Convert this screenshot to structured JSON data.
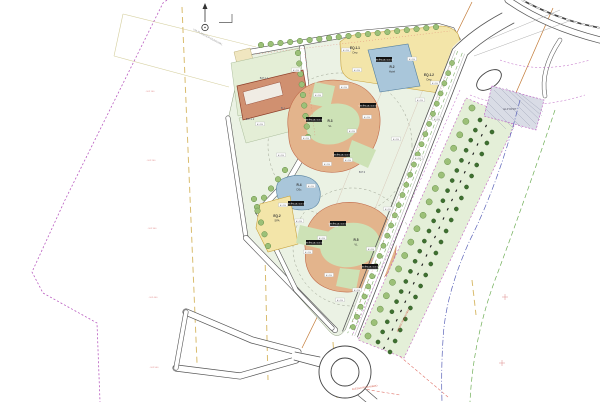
{
  "palette": {
    "paper": "#ffffff",
    "block_green": "#ebf2e4",
    "parcel_green": "#e4eed6",
    "ring_green": "#cde2b6",
    "lobe_tan": "#e3b48c",
    "lobe_stroke": "#c06a4a",
    "parcel_yellow": "#f3e5a9",
    "parcel_blue": "#a9c6da",
    "building_brown": "#d09070",
    "tree_light": "#9cc078",
    "tree_dark": "#3e7030",
    "road_casing": "#555555",
    "boundary_purple": "#b95cc0",
    "cad_yellow": "#d9bc6e",
    "cad_orange": "#c27a36",
    "cad_red": "#e0736a",
    "cad_blue": "#5b63b8",
    "cad_green": "#6fae57",
    "elp_gray": "#d9dce6"
  },
  "parcels": {
    "eq11": {
      "code": "EQ.1.1",
      "use": "Dep"
    },
    "r2": {
      "code": "R.2",
      "use": "Hotel"
    },
    "eq12": {
      "code": "EQ.1.2",
      "use": "Dep"
    },
    "r3": {
      "code": "R.3",
      "use": "VL"
    },
    "r4": {
      "code": "R.4",
      "use": "DSc"
    },
    "eq2": {
      "code": "EQ.2",
      "use": "SPA"
    },
    "r5": {
      "code": "R.5",
      "use": "VL"
    },
    "b1": {
      "code": "B.1"
    },
    "bp11": {
      "code": "B.P.1.1"
    },
    "bp12": {
      "code": "B.P.1.2"
    },
    "bp3": {
      "code": "B.P.3"
    },
    "elp": {
      "code": "ELP DPRT"
    }
  },
  "annotations": {
    "street_label": "VIA PLANEADA MUNICIPAL",
    "access_road_1": "ACESSO RODOVIÁRIO",
    "access_road_2": "ACESSO RODOVIÁRIO",
    "black_box_text": "CEDÊNCIA 2.400 m²",
    "mini_label_text": "A 1.250",
    "grid_labels": [
      "-102 100",
      "-102 200",
      "-102 300",
      "-102 400",
      "-102 500"
    ]
  },
  "decor": {
    "tree_rows": [
      {
        "x1": 261,
        "y1": 45,
        "x2": 436,
        "y2": 27,
        "n": 19,
        "r": 2.8,
        "t": "light"
      },
      {
        "x1": 298,
        "y1": 53,
        "x2": 308,
        "y2": 137,
        "n": 9,
        "r": 2.8,
        "t": "light"
      },
      {
        "x1": 285,
        "y1": 170,
        "x2": 257,
        "y2": 207,
        "n": 5,
        "r": 2.8,
        "t": "light"
      },
      {
        "x1": 452,
        "y1": 63,
        "x2": 353,
        "y2": 327,
        "n": 27,
        "r": 2.6,
        "t": "light"
      },
      {
        "x1": 254,
        "y1": 199,
        "x2": 268,
        "y2": 246,
        "n": 5,
        "r": 2.8,
        "t": "light"
      },
      {
        "x1": 472,
        "y1": 108,
        "x2": 368,
        "y2": 336,
        "n": 18,
        "r": 3.1,
        "t": "light"
      },
      {
        "x1": 480,
        "y1": 120,
        "x2": 378,
        "y2": 342,
        "n": 23,
        "r": 2.1,
        "t": "dark"
      },
      {
        "x1": 492,
        "y1": 132,
        "x2": 390,
        "y2": 352,
        "n": 21,
        "r": 2.1,
        "t": "dark"
      }
    ],
    "hatch_row": {
      "x1": 486,
      "y1": 126,
      "x2": 384,
      "y2": 348,
      "n": 25
    },
    "mini_labels": [
      [
        318,
        95
      ],
      [
        344,
        87
      ],
      [
        306,
        138
      ],
      [
        352,
        131
      ],
      [
        367,
        117
      ],
      [
        327,
        164
      ],
      [
        348,
        160
      ],
      [
        296,
        70
      ],
      [
        260,
        124
      ],
      [
        281,
        155
      ],
      [
        299,
        221
      ],
      [
        334,
        225
      ],
      [
        371,
        249
      ],
      [
        329,
        275
      ],
      [
        357,
        290
      ],
      [
        346,
        50
      ],
      [
        412,
        59
      ],
      [
        435,
        83
      ],
      [
        396,
        139
      ],
      [
        418,
        158
      ],
      [
        388,
        209
      ],
      [
        437,
        119
      ],
      [
        311,
        186
      ],
      [
        283,
        205
      ],
      [
        357,
        70
      ],
      [
        322,
        238
      ],
      [
        372,
        268
      ],
      [
        340,
        300
      ],
      [
        308,
        252
      ],
      [
        420,
        100
      ]
    ],
    "black_boxes": [
      [
        306,
        117
      ],
      [
        334,
        152
      ],
      [
        360,
        103
      ],
      [
        306,
        240
      ],
      [
        330,
        221
      ],
      [
        362,
        264
      ],
      [
        288,
        201
      ],
      [
        376,
        57
      ]
    ],
    "grid_crosses": [
      [
        505,
        297
      ],
      [
        502,
        363
      ]
    ]
  }
}
